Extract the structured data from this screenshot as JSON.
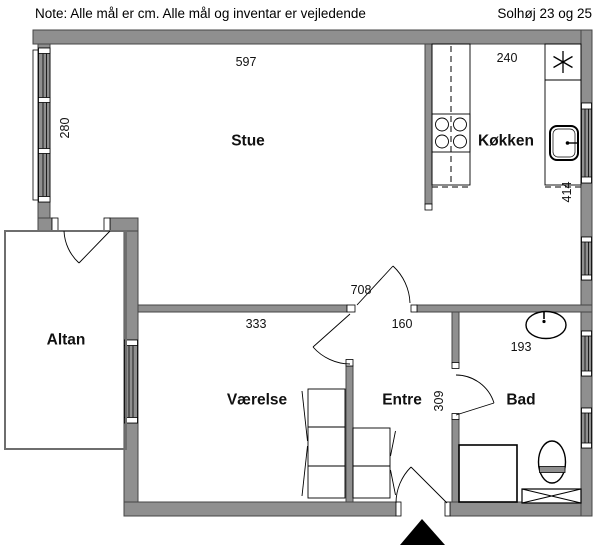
{
  "header": {
    "note": "Note: Alle mål er cm. Alle mål og inventar er vejledende",
    "title": "Solhøj 23 og 25"
  },
  "rooms": {
    "stue": "Stue",
    "kokken": "Køkken",
    "altan": "Altan",
    "vaerelse": "Værelse",
    "entre": "Entre",
    "bad": "Bad"
  },
  "dimensions_cm": {
    "stue_width": "597",
    "stue_depth": "280",
    "kokken_width": "240",
    "kokken_depth": "414",
    "total_lower_width": "708",
    "vaerelse_width": "333",
    "entre_width": "160",
    "entre_depth": "309",
    "bad_width": "193"
  },
  "icons": {
    "cooker_hood": "asterisk-star",
    "entrance_marker": "solid-black-triangle-up"
  },
  "colors": {
    "wall_fill": "#8f8f8f",
    "line": "#000000",
    "background": "#ffffff"
  }
}
